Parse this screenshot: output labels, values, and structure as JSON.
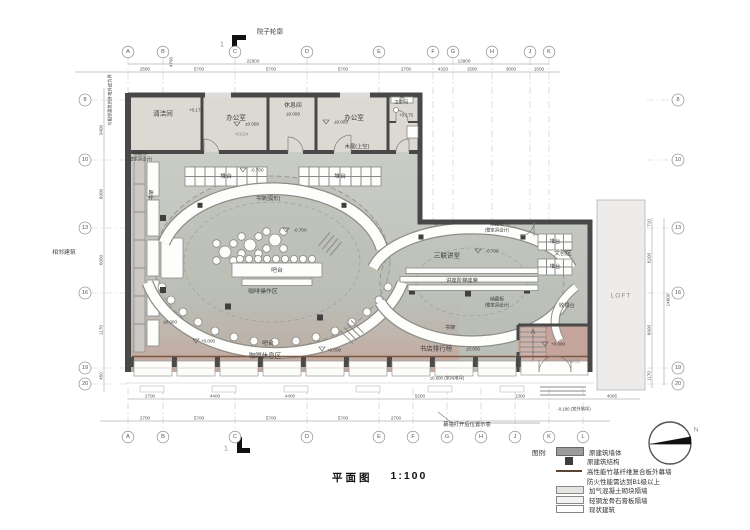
{
  "title": {
    "label": "平面图",
    "scale": "1:100"
  },
  "section_marker": "1",
  "north_label": "N",
  "site": {
    "courtyard": "院子轮廓",
    "adjacent": "相邻建筑",
    "boundary_note": "与相邻建筑的外墙外皮为界",
    "curtain_note": "幕墙打开后位置示意",
    "loft": "LOFT",
    "wood_house": "木屋(上空)"
  },
  "rooms": {
    "cleaning": "清洁间",
    "office": "办公室",
    "rest": "休息间",
    "bath": "卫生间",
    "storage1": "储藏柜",
    "storage2": "(整家具设计)",
    "bookshelf": "书架",
    "bookshelf_arc": "书架(弧形)",
    "display_table": "堆台",
    "bar": "吧台",
    "coffee_prep": "咖啡操作区",
    "coffee_lounge": "咖啡休息区",
    "lecture": "三联讲堂",
    "lecture_seats": "讲座阶梯座席",
    "ranking": "书店排行榜",
    "cultural": "文创区",
    "cashier": "收银台"
  },
  "levels": {
    "zero": "±0.000",
    "zero_plus": "+0.000",
    "minus700": "-0.700",
    "plus175": "+0.175",
    "outdoor": "-0.180 (室外地坪)",
    "indoor": "±0.000 (室内地坪)"
  },
  "doors": {
    "m1024": "M1024",
    "m1832": "M1832"
  },
  "grid": {
    "top": [
      "A",
      "B",
      "C",
      "D",
      "E",
      "F",
      "G",
      "H",
      "J",
      "K"
    ],
    "bottom": [
      "A",
      "B",
      "C",
      "D",
      "E",
      "F",
      "G",
      "H",
      "J",
      "K",
      "L"
    ],
    "left": [
      "8",
      "10",
      "13",
      "16",
      "19",
      "20"
    ],
    "right": [
      "8",
      "10",
      "13",
      "16",
      "19",
      "20"
    ]
  },
  "dims": {
    "top": [
      "2580",
      "5700",
      "5700",
      "5700",
      "2700",
      "4320",
      "1580",
      "3000",
      "1500"
    ],
    "top_total_left": "22900",
    "top_total_right": "13900",
    "bottom_upper": [
      "2700",
      "4400",
      "4400",
      "5200",
      "1300",
      "4095"
    ],
    "bottom_lower": [
      "2700",
      "5700",
      "5700",
      "5700",
      "2700"
    ],
    "left": [
      "450",
      "3400",
      "6000",
      "6000",
      "1170"
    ],
    "left_extra": "4790",
    "right": [
      "710",
      "6200",
      "6000",
      "1170"
    ],
    "right_total": "14600"
  },
  "legend": {
    "title": "图例:",
    "items": [
      {
        "label": "原建筑墙体"
      },
      {
        "label": "原建筑结构"
      },
      {
        "label": "高性能竹基纤维复合板外幕墙"
      },
      {
        "label": "防火性能需达到B1级以上"
      },
      {
        "label": "加气混凝土砌块隔墙"
      },
      {
        "label": "轻钢龙骨石膏板隔墙"
      },
      {
        "label": "现状建筑"
      }
    ]
  },
  "colors": {
    "wall": "#484848",
    "floor": "#c3c7c0",
    "floor_pink": "#cfada5",
    "rooms": "#dcd9d2",
    "curtain_brown": "#7a5743"
  }
}
